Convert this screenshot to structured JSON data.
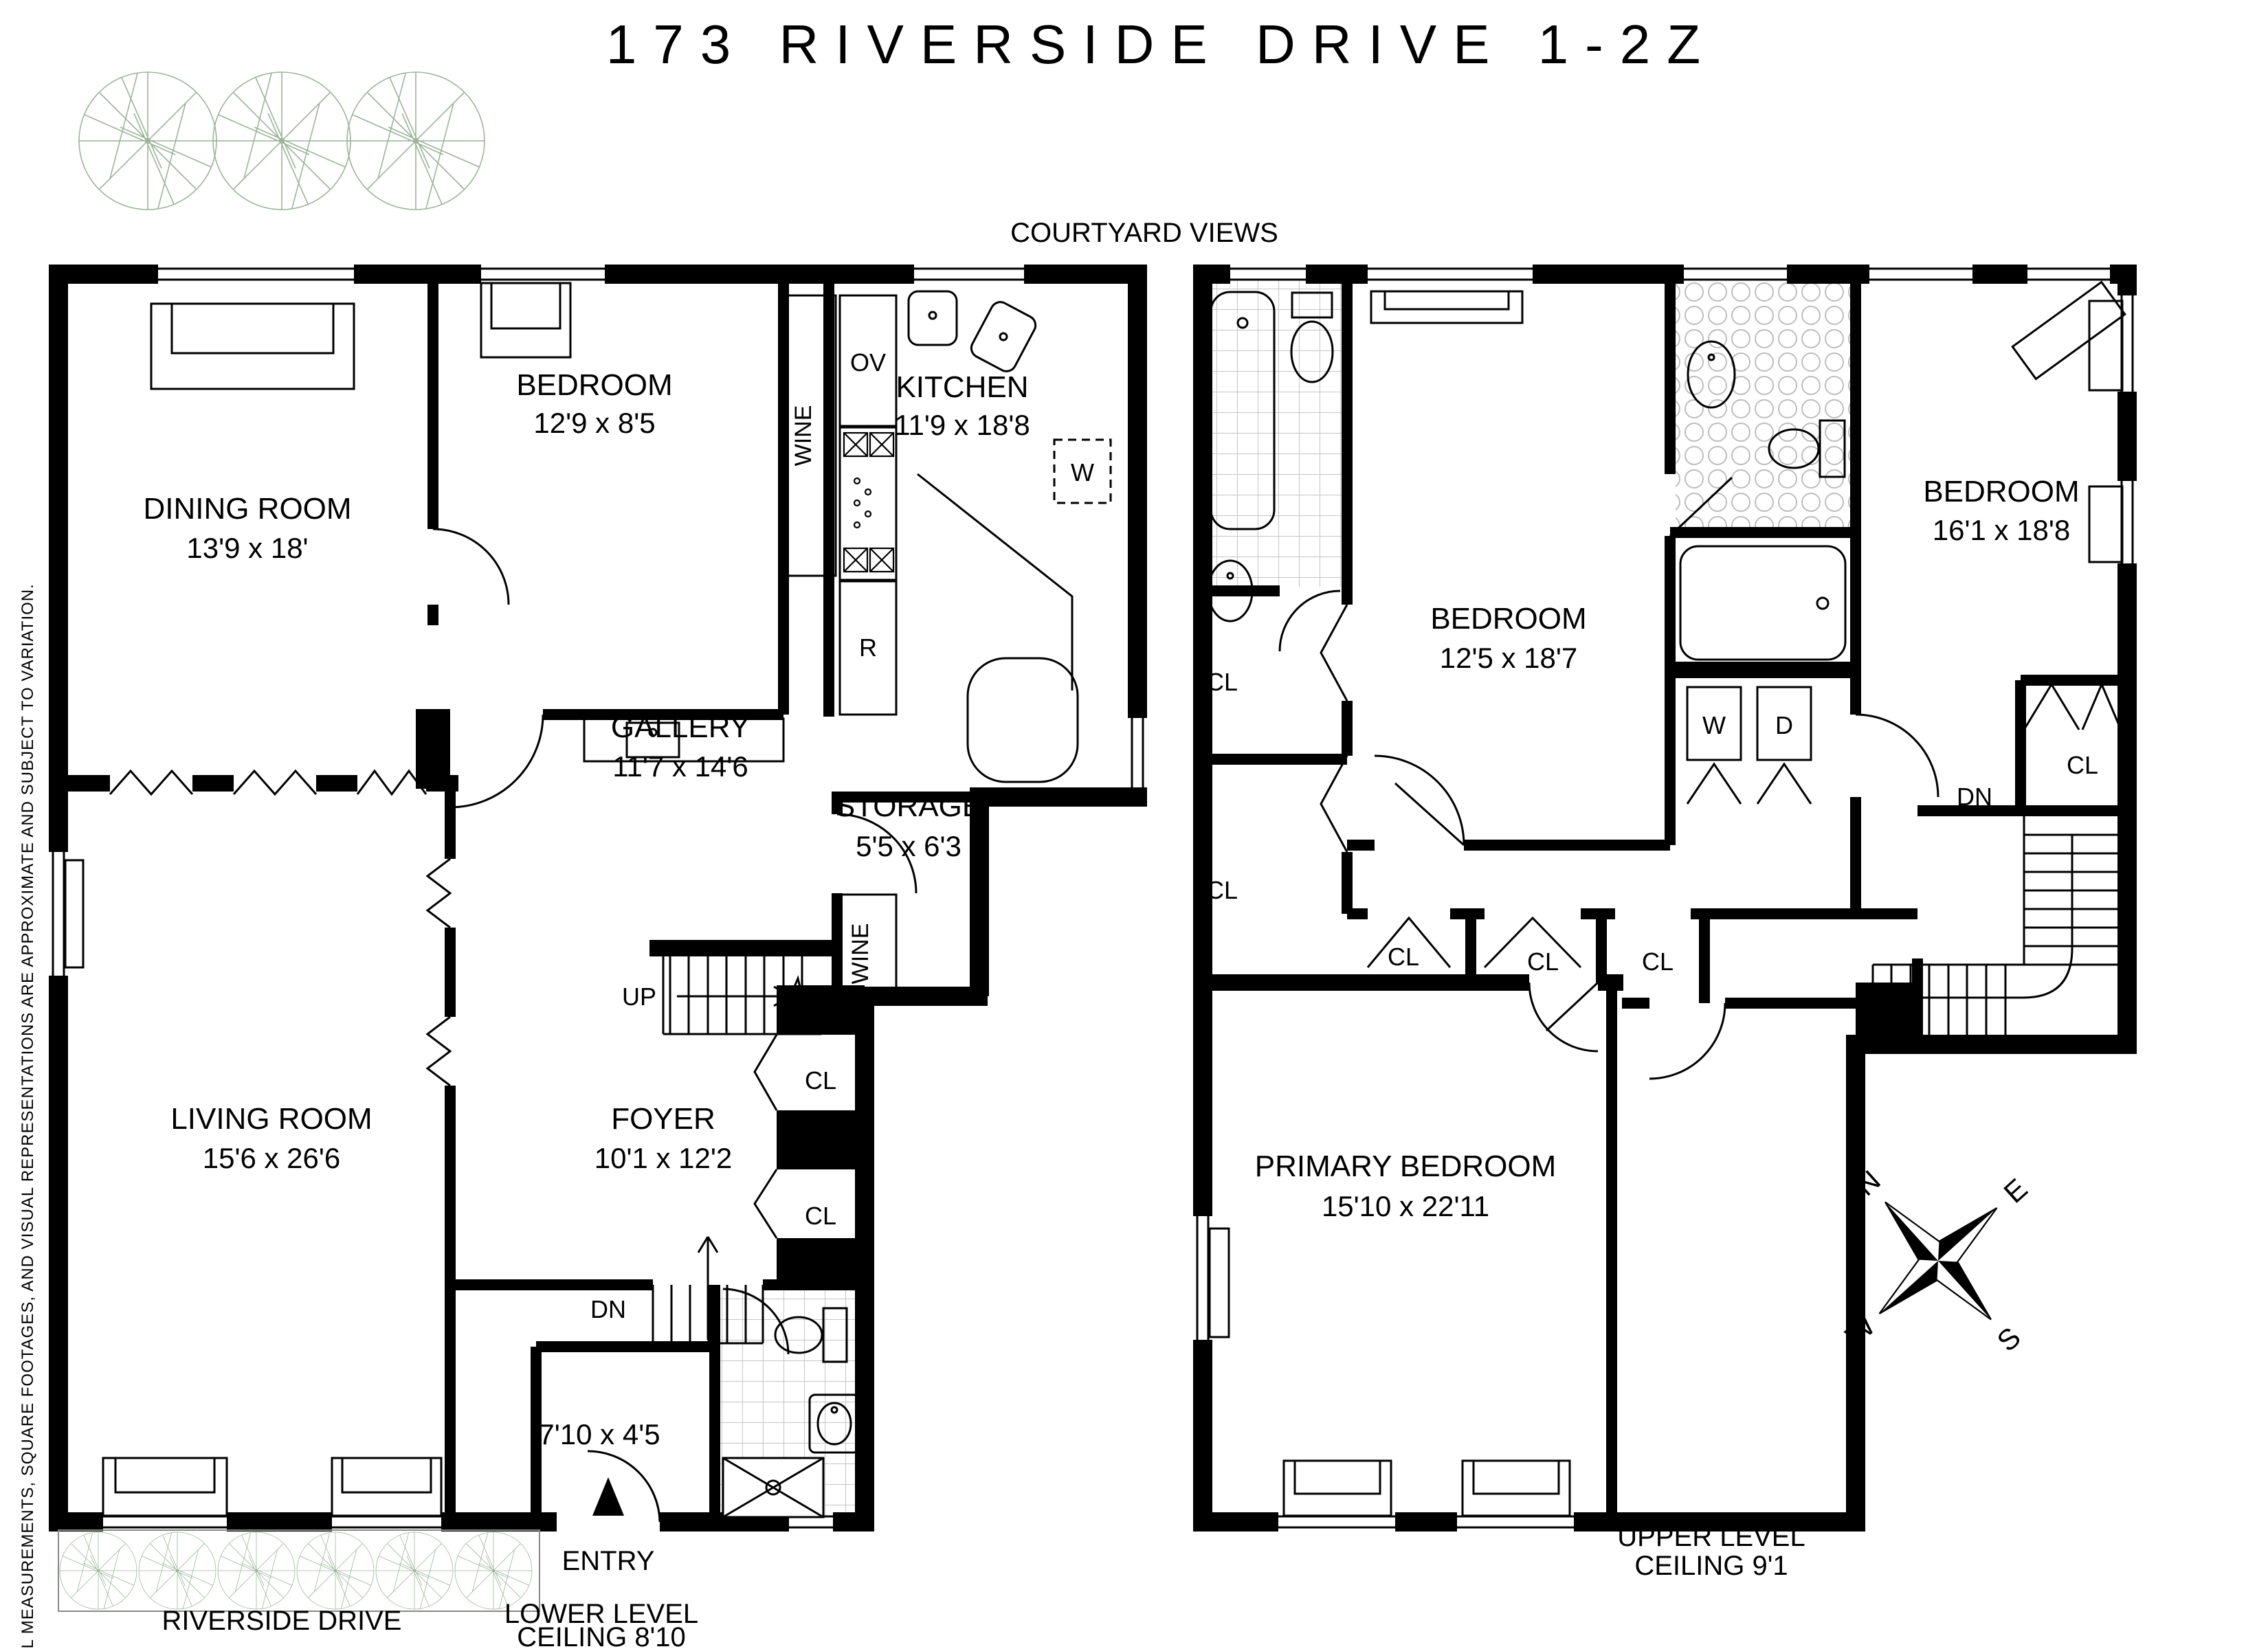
{
  "title": "173 RIVERSIDE DRIVE 1-2Z",
  "annotations": {
    "courtyard_views": "COURTYARD VIEWS",
    "riverside_drive": "RIVERSIDE DRIVE",
    "entry": "ENTRY",
    "lower_level_line1": "LOWER LEVEL",
    "lower_level_line2": "CEILING 8'10",
    "upper_level_line1": "UPPER LEVEL",
    "upper_level_line2": "CEILING 9'1",
    "disclaimer": "ALL MEASUREMENTS, SQUARE FOOTAGES, AND VISUAL REPRESENTATIONS ARE APPROXIMATE AND SUBJECT TO VARIATION."
  },
  "lower_level": {
    "dining_room": {
      "name": "DINING ROOM",
      "dims": "13'9 x 18'"
    },
    "bedroom": {
      "name": "BEDROOM",
      "dims": "12'9 x 8'5"
    },
    "kitchen": {
      "name": "KITCHEN",
      "dims": "11'9 x 18'8"
    },
    "gallery": {
      "name": "GALLERY",
      "dims": "11'7 x 14'6"
    },
    "storage": {
      "name": "STORAGE",
      "dims": "5'5 x 6'3"
    },
    "living_room": {
      "name": "LIVING ROOM",
      "dims": "15'6 x 26'6"
    },
    "foyer": {
      "name": "FOYER",
      "dims": "10'1 x 12'2"
    },
    "vestibule_dims": "7'10 x 4'5",
    "labels": {
      "wine_upper": "WINE",
      "wine_lower": "WINE",
      "oven": "OV",
      "refrigerator": "R",
      "washer": "W",
      "up": "UP",
      "down": "DN",
      "closet_a": "CL",
      "closet_b": "CL"
    }
  },
  "upper_level": {
    "bedroom_west": {
      "name": "BEDROOM",
      "dims": "12'5 x 18'7"
    },
    "bedroom_east": {
      "name": "BEDROOM",
      "dims": "16'1 x 18'8"
    },
    "primary_bedroom": {
      "name": "PRIMARY BEDROOM",
      "dims": "15'10 x 22'11"
    },
    "labels": {
      "washer": "W",
      "dryer": "D",
      "down": "DN"
    },
    "closets": [
      "CL",
      "CL",
      "CL",
      "CL",
      "CL",
      "CL"
    ]
  },
  "compass": {
    "north": "N",
    "east": "E",
    "south": "S",
    "west": "W"
  },
  "colors": {
    "wall": "#000000",
    "tree": "#9cb49a",
    "tile_line": "#c5c5c5"
  }
}
